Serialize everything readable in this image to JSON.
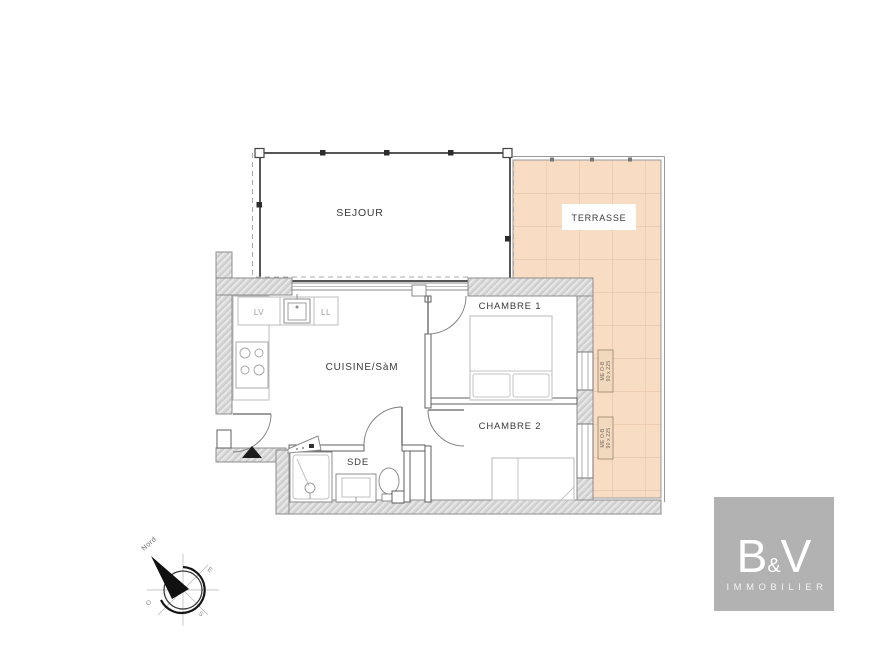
{
  "plan": {
    "rooms": {
      "sejour": "SEJOUR",
      "terrasse": "TERRASSE",
      "cuisine": "CUISINE/SàM",
      "chambre1": "CHAMBRE 1",
      "chambre2": "CHAMBRE 2",
      "sde": "SDE"
    },
    "appliances": {
      "lv": "LV",
      "ll": "LL"
    },
    "window_spec": {
      "line1": "ME O-B",
      "line2": "90 x 225"
    },
    "compass": {
      "north": "Nord",
      "east": "E",
      "west": "O",
      "south": "S"
    }
  },
  "logo": {
    "b": "B",
    "amp": "&",
    "v": "V",
    "subtitle": "IMMOBILIER"
  },
  "colors": {
    "terrace_fill": "#f8dcc3",
    "terrace_grid": "#e3c0a2",
    "wall_fill": "#d9d9d9",
    "logo_bg": "#b2b2b2"
  }
}
